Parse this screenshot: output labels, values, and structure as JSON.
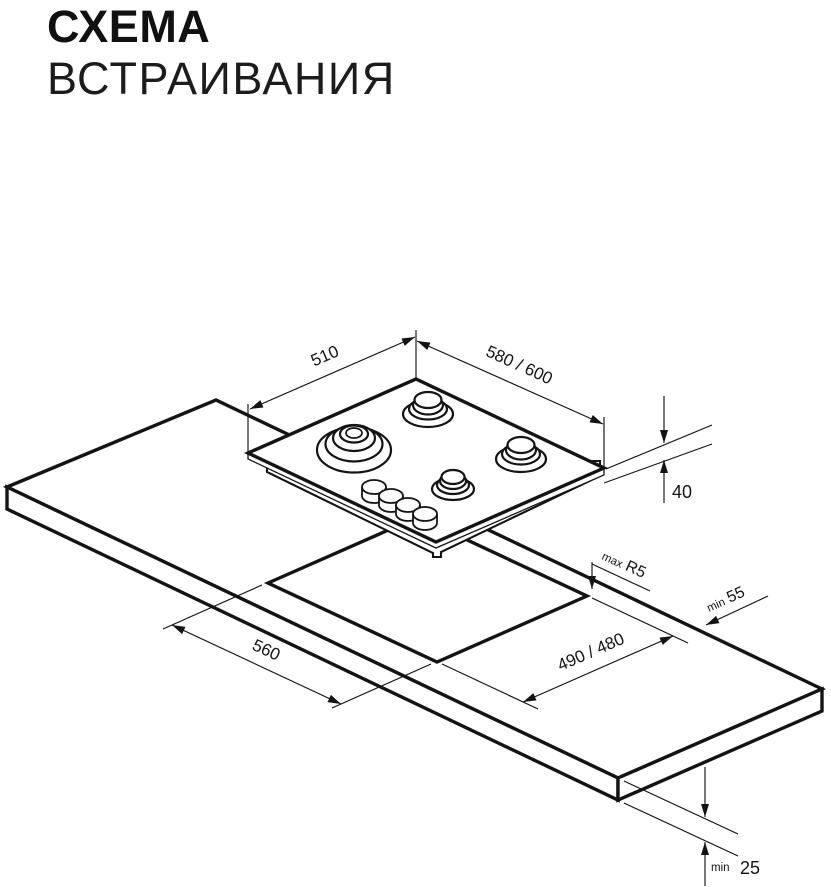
{
  "title": {
    "line1": "СХЕМА",
    "line2": "ВСТРАИВАНИЯ"
  },
  "colors": {
    "line": "#141414",
    "background": "#ffffff"
  },
  "annotations": {
    "hob_width": {
      "value": "510"
    },
    "hob_depth": {
      "value": "580 / 600"
    },
    "hob_height": {
      "value": "40"
    },
    "corner_radius": {
      "prefix": "max",
      "value": "R5"
    },
    "rear_clearance": {
      "prefix": "min",
      "value": "55"
    },
    "cutout_width": {
      "value": "560"
    },
    "cutout_depth": {
      "value": "490 / 480"
    },
    "worktop_thickness": {
      "prefix": "min",
      "value": "25"
    }
  }
}
